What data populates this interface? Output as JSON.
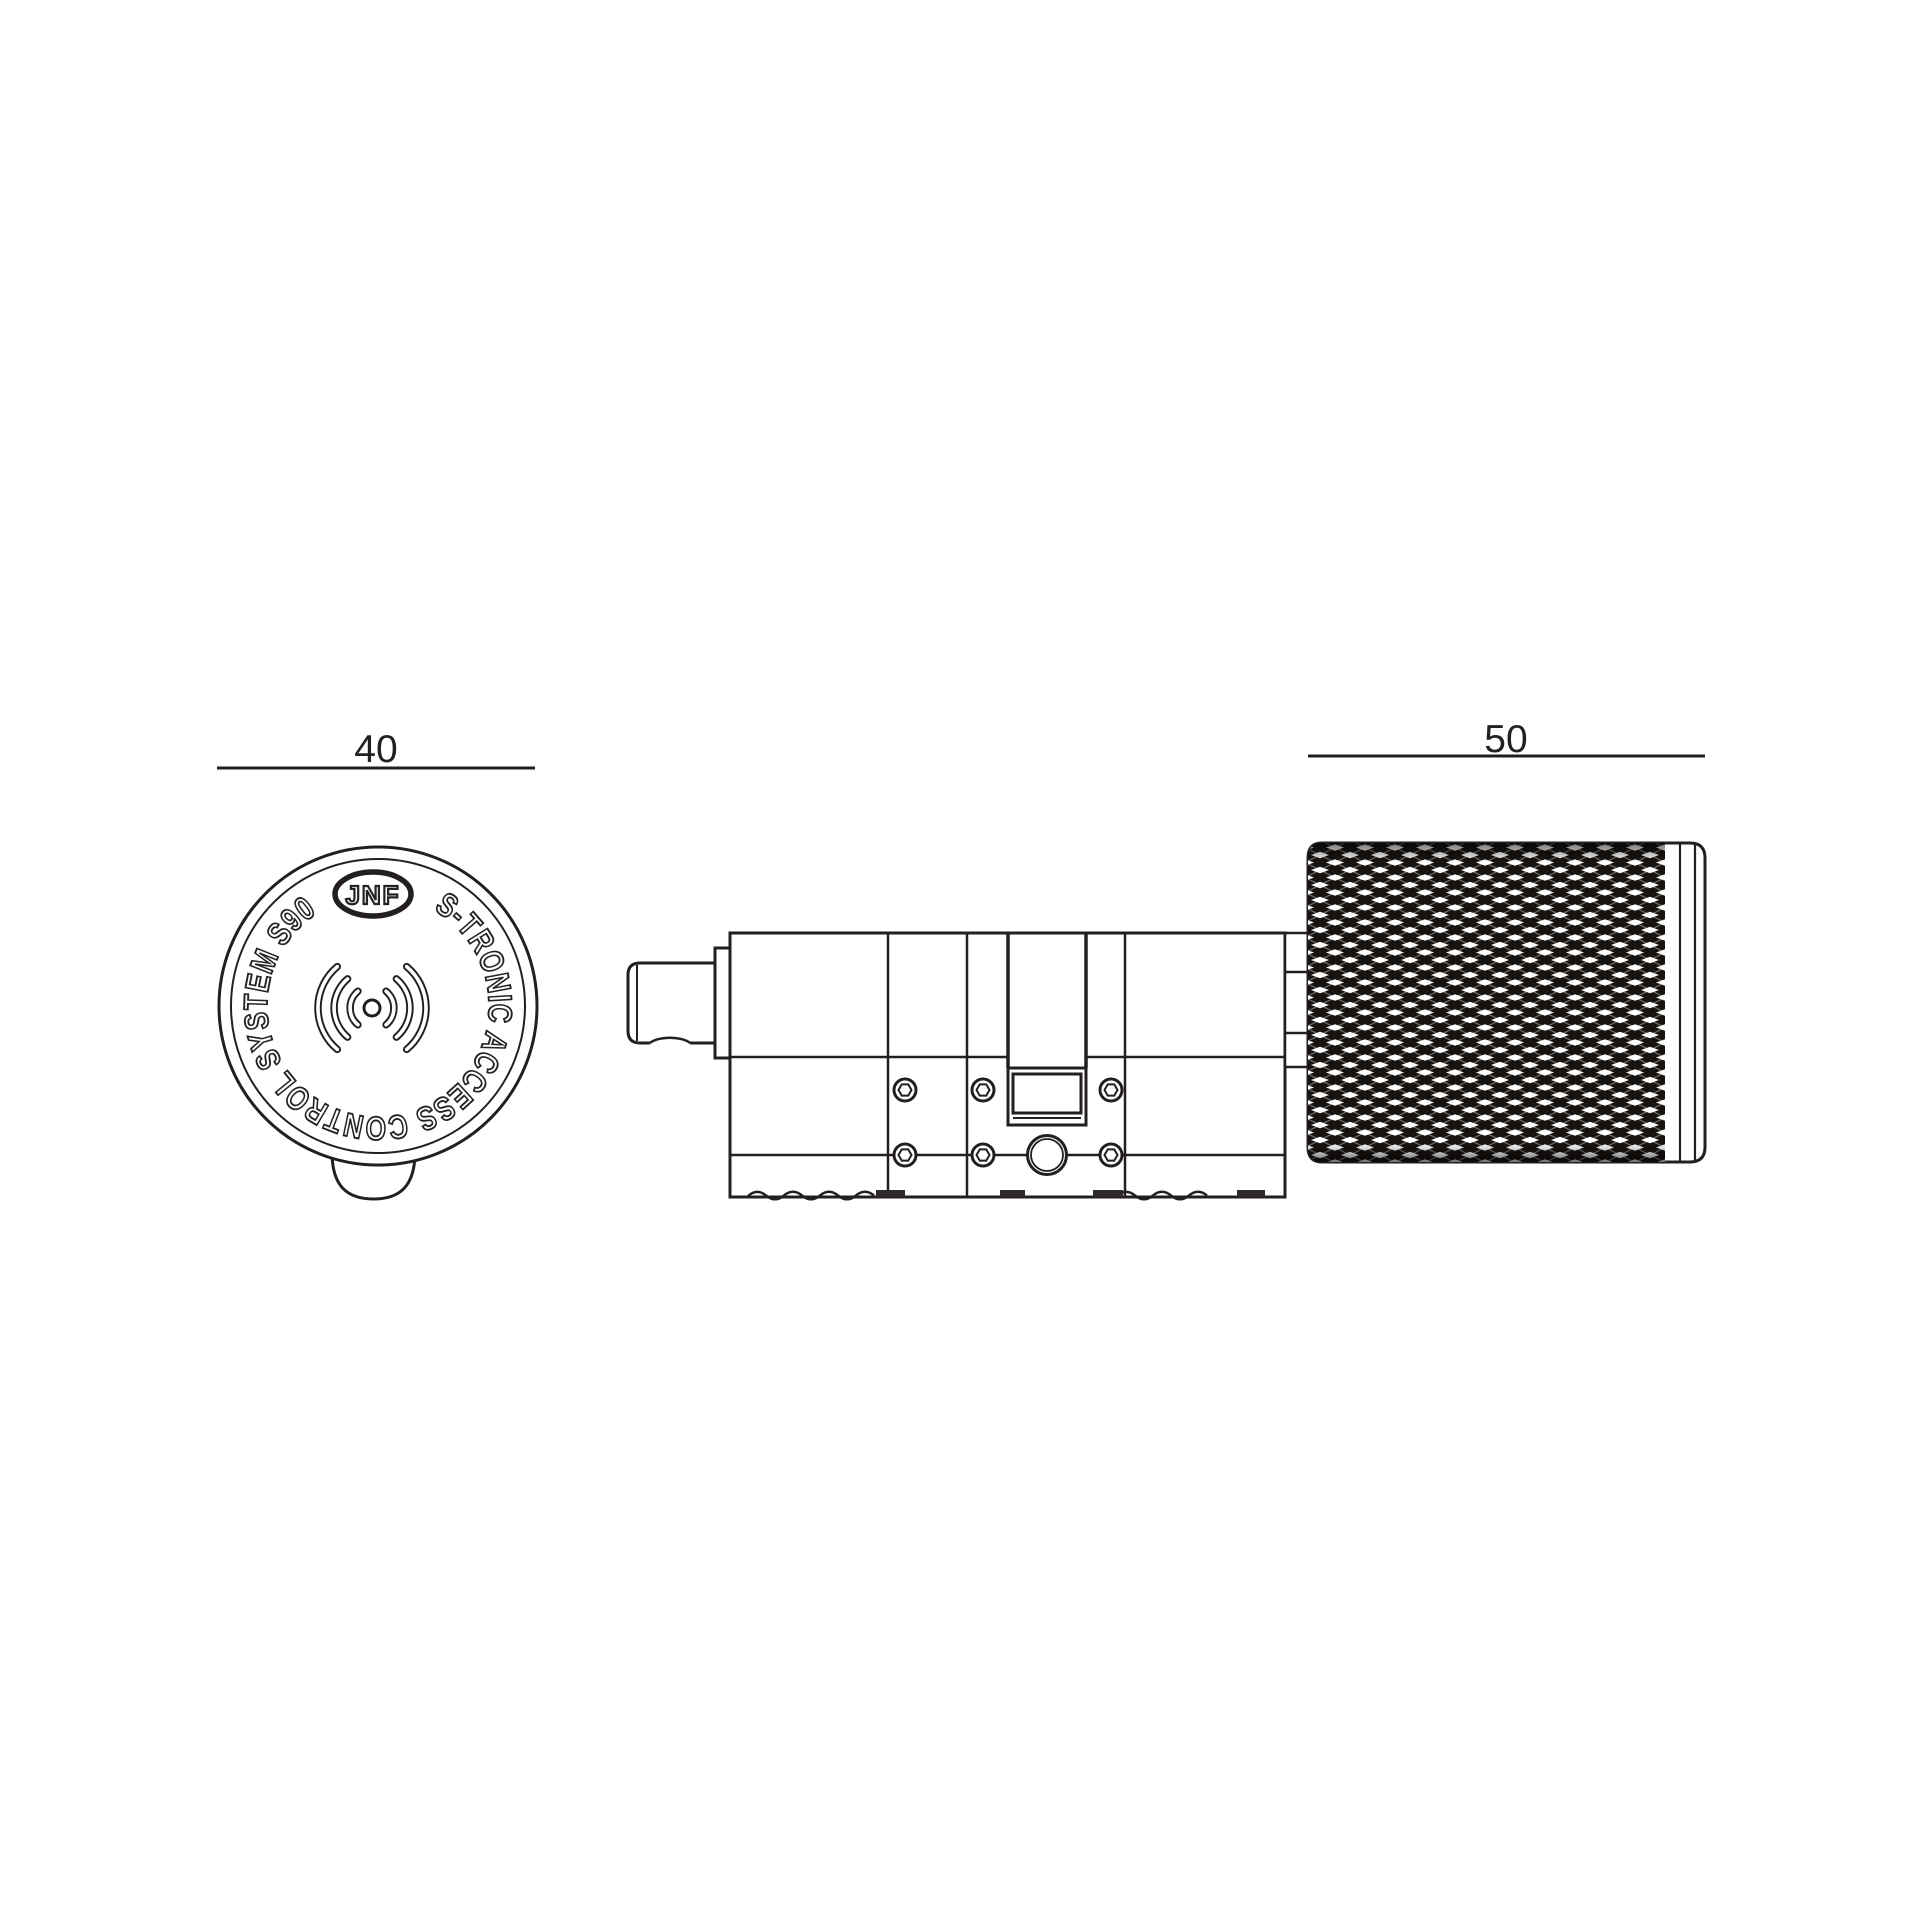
{
  "page": {
    "background": "#ffffff"
  },
  "colors": {
    "line": "#231f20",
    "knurl_dark": "#171310",
    "knurl_light": "#fdfdfd",
    "foot_dark": "#2f2b28"
  },
  "front_view": {
    "dimension_label": "40",
    "logo_label": "JNF",
    "ring_text": "S-TRONIC ACCESS CONTROL SYSTEM S90",
    "icon": "contactless-signal-icon"
  },
  "side_view": {
    "dimension_label": "50"
  }
}
